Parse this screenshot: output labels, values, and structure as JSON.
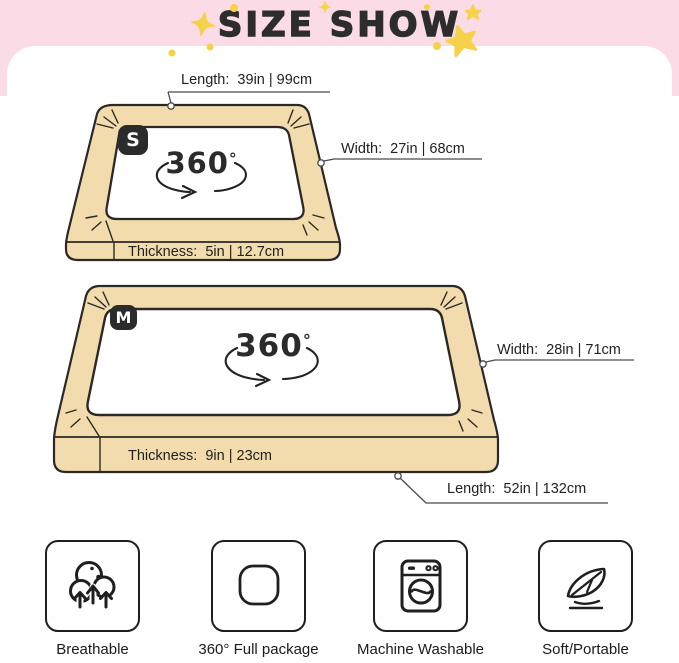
{
  "header": {
    "title": "SIZE SHOW"
  },
  "beds": {
    "s": {
      "badge": "S",
      "rotate": "360",
      "rotate_degree": "°",
      "length": "Length:  39in | 99cm",
      "width": "Width:  27in | 68cm",
      "thickness": "Thickness:  5in | 12.7cm"
    },
    "m": {
      "badge": "M",
      "rotate": "360",
      "rotate_degree": "°",
      "width": "Width:  28in | 71cm",
      "thickness": "Thickness:  9in | 23cm",
      "length": "Length:  52in | 132cm"
    }
  },
  "features": [
    {
      "icon": "breathable-icon",
      "label": "Breathable"
    },
    {
      "icon": "full-package-icon",
      "label": "360° Full package"
    },
    {
      "icon": "washing-machine-icon",
      "label": "Machine Washable"
    },
    {
      "icon": "feather-icon",
      "label": "Soft/Portable"
    }
  ],
  "colors": {
    "header_pink": "#fbdce6",
    "bed_tan": "#f2dcae",
    "outline_dark": "#2b2825",
    "star_yellow": "#f6d24b",
    "badge_bg": "#2b2b2b",
    "text": "#222222"
  }
}
